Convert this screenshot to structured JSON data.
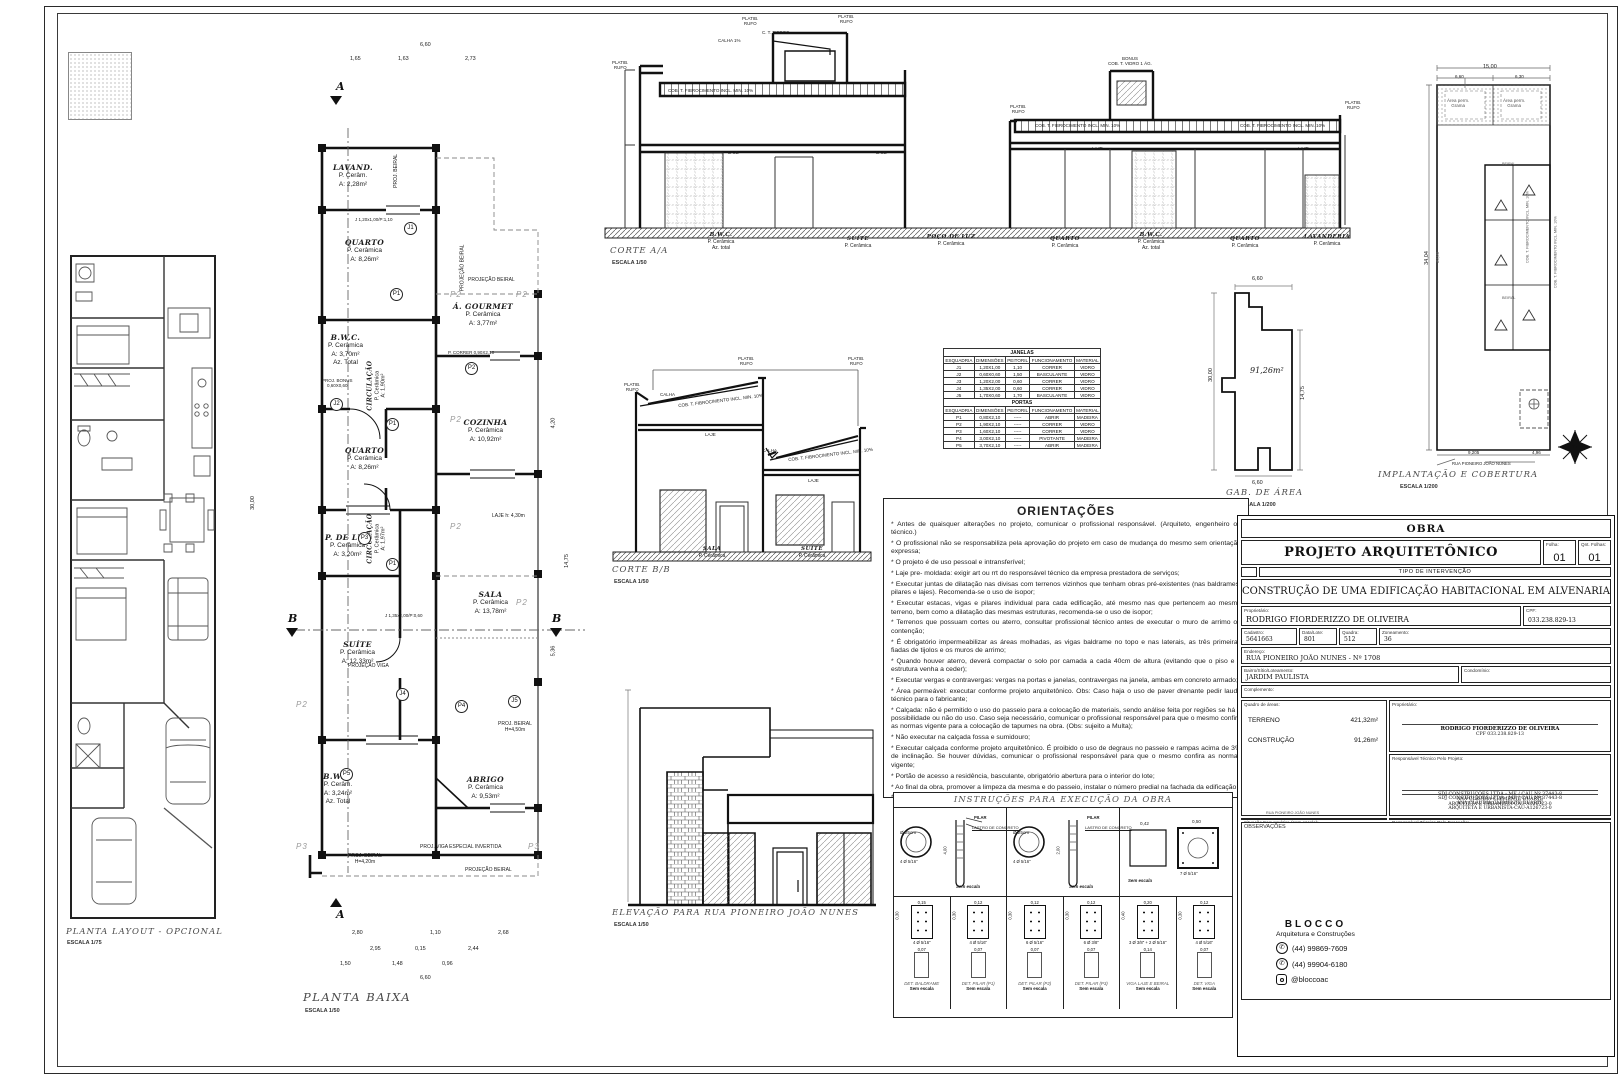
{
  "markers": {
    "a": "A",
    "b": "B"
  },
  "planta_layout": {
    "title": "PLANTA LAYOUT - OPCIONAL",
    "scale": "ESCALA 1/75"
  },
  "planta_baixa": {
    "title": "PLANTA BAIXA",
    "scale": "ESCALA 1/50",
    "rooms": [
      {
        "name": "LAVAND.",
        "floor": "P. Cerâm.",
        "area": "A: 2,28m²"
      },
      {
        "name": "QUARTO",
        "floor": "P. Cerâmica",
        "area": "A: 8,26m²"
      },
      {
        "name": "Á. GOURMET",
        "floor": "P. Cerâmica",
        "area": "A: 3,77m²"
      },
      {
        "name": "B.W.C.",
        "floor": "P. Cerâmica",
        "area": "A: 3,70m²",
        "extra": "Az. Total"
      },
      {
        "name": "CIRCULAÇÃO",
        "floor": "P. Cerâmica",
        "area": "A: 1,90m²"
      },
      {
        "name": "QUARTO",
        "floor": "P. Cerâmica",
        "area": "A: 8,26m²"
      },
      {
        "name": "COZINHA",
        "floor": "P. Cerâmica",
        "area": "A: 10,92m²"
      },
      {
        "name": "P. DE LUZ",
        "floor": "P. Cerâmica",
        "area": "A: 3,20m²"
      },
      {
        "name": "CIRCULAÇÃO",
        "floor": "P. Cerâmica",
        "area": "A: 1,97m²"
      },
      {
        "name": "SALA",
        "floor": "P. Cerâmica",
        "area": "A: 13,78m²"
      },
      {
        "name": "SUÍTE",
        "floor": "P. Cerâmica",
        "area": "A: 12,33m²"
      },
      {
        "name": "B.W.C.",
        "floor": "P. Cerâm.",
        "area": "A: 3,24m²",
        "extra": "Az. Total"
      },
      {
        "name": "ABRIGO",
        "floor": "P. Cerâmica",
        "area": "A: 9,53m²"
      }
    ],
    "ann": {
      "proj_beiral": "PROJ. BEIRAL",
      "projecao_beiral": "PROJEÇÃO BEIRAL",
      "laje": "LAJE  h: 4,30m",
      "projecao_viga": "PROJEÇÃO VIGA",
      "proj_viga_esp": "PROJ. VIGA ESPECIAL INVERTIDA",
      "beiral450a": "PROJ. BEIRAL",
      "beiral450b": "H=4,50m",
      "beiral420a": "PROJ. BEIRAL",
      "beiral420b": "H=4,20m",
      "bonus1": "PROJ. BONUS",
      "bonus2": "0,60X0,60",
      "j1": "J 1,20x1,00/P:1,10",
      "p2t": "P. CORRER 0,90X2,10",
      "j4": "J 1,35x2,00/P:0,60",
      "tagJ1": "J1",
      "tagJ2": "J2",
      "tagJ4": "J4",
      "tagJ5": "J5",
      "tagP1": "P1",
      "tagP2": "P2",
      "tagP3": "P3",
      "tagP4": "P4",
      "tagP5": "P5",
      "p2g": "P2",
      "p3g": "P3"
    },
    "dims": {
      "top": "6,60",
      "t1": "1,65",
      "t2": "1,63",
      "t3": "2,73",
      "left": "30,00",
      "r1": "4,20",
      "r2": "14,75",
      "r3": "5,36",
      "b1a": "2,80",
      "b1b": "1,10",
      "b1c": "2,68",
      "b2a": "2,95",
      "b2b": "0,15",
      "b2c": "2,44",
      "b3a": "1,50",
      "b3b": "1,48",
      "b3c": "0,96",
      "b4": "6,60"
    }
  },
  "corte_a": {
    "title": "CORTE A/A",
    "scale": "ESCALA 1/50",
    "rooms": [
      {
        "name": "B.W.C.",
        "floor": "P. Cerâmica",
        "extra": "Az. total"
      },
      {
        "name": "SUÍTE",
        "floor": "P. Cerâmica"
      },
      {
        "name": "POÇO DE LUZ",
        "floor": "P. Cerâmica"
      },
      {
        "name": "QUARTO",
        "floor": "P. Cerâmica"
      },
      {
        "name": "B.W.C.",
        "floor": "P. Cerâmica",
        "extra": "Az. total"
      },
      {
        "name": "QUARTO",
        "floor": "P. Cerâmica"
      },
      {
        "name": "LAVANDERIA",
        "floor": "P. Cerâmica"
      }
    ],
    "ann": {
      "platib": "PLATIB.",
      "rufo": "RUFO",
      "caixa": "C. T. FIBROC.",
      "calha": "CALHA 1%",
      "cob": "COB. T. FIBROCIMENTO INCL. MIN. 10%",
      "bonus": "BONUS",
      "vidro": "COB. T. VIDRO 1 ÁG.",
      "laje": "LAJE"
    }
  },
  "corte_b": {
    "title": "CORTE B/B",
    "scale": "ESCALA 1/50",
    "rooms": [
      {
        "name": "SALA",
        "floor": "P. Cerâmica"
      },
      {
        "name": "SUÍTE",
        "floor": "P. Cerâmica"
      }
    ],
    "ann": {
      "platib": "PLATIB.",
      "rufo": "RUFO",
      "calha": "CALHA",
      "cob": "COB. T. FIBROCIMENTO INCL. MIN. 10%",
      "laje": "LAJE"
    }
  },
  "schedule": {
    "janelas_title": "JANELAS",
    "portas_title": "PORTAS",
    "headers": [
      "ESQUADRIA",
      "DIMENSÕES",
      "PEITORIL",
      "FUNCIONAMENTO",
      "MATERIAL"
    ],
    "janelas": [
      [
        "J1",
        "1,20X1,00",
        "1,10",
        "CORRER",
        "VIDRO"
      ],
      [
        "J2",
        "0,60X0,60",
        "1,50",
        "BASCULANTE",
        "VIDRO"
      ],
      [
        "J3",
        "1,20X2,00",
        "0,60",
        "CORRER",
        "VIDRO"
      ],
      [
        "J4",
        "1,35X2,00",
        "0,60",
        "CORRER",
        "VIDRO"
      ],
      [
        "J5",
        "1,70X0,60",
        "1,70",
        "BASCULANTE",
        "VIDRO"
      ]
    ],
    "portas": [
      [
        "P1",
        "0,80X2,10",
        "-----",
        "ABRIR",
        "MADEIRA"
      ],
      [
        "P2",
        "1,90X2,10",
        "-----",
        "CORRER",
        "VIDRO"
      ],
      [
        "P3",
        "1,60X2,10",
        "-----",
        "CORRER",
        "VIDRO"
      ],
      [
        "P4",
        "3,00X2,10",
        "-----",
        "PIVOTANTE",
        "MADEIRA"
      ],
      [
        "P5",
        "3,70X2,10",
        "-----",
        "ABRIR",
        "MADEIRA"
      ]
    ]
  },
  "gab": {
    "title": "GAB. DE ÁREA",
    "scale": "ESCALA 1/200",
    "area": "91,26m²",
    "dim_top": "6,60",
    "dim_left": "30,00",
    "dim_right": "14,75",
    "dim_bottom": "6,60"
  },
  "implantacao": {
    "title": "IMPLANTAÇÃO E COBERTURA",
    "scale": "ESCALA 1/200",
    "street": "RUA PIONEIRO JOÃO NUNES",
    "perm1": "Área perm.",
    "perm2": "Grama",
    "dim_top": "15,00",
    "dim_t1": "6,60",
    "dim_t2": "6,30",
    "dim_left": "34,04",
    "dim_left2": "30,00",
    "dim_b1": "9,205",
    "dim_b2": "4,96",
    "beiral": "BEIRAL",
    "cob": "COB. T. FIBROCIMENTO INCL. MIN. 10%"
  },
  "orientacoes": {
    "title": "ORIENTAÇÕES",
    "items": [
      "* Antes de quaisquer alterações no projeto, comunicar o profissional responsável. (Arquiteto, engenheiro ou técnico.)",
      "* O profissional não se responsabiliza pela aprovação do projeto em caso de mudança do mesmo sem orientação expressa;",
      "* O projeto é de uso pessoal e intransferível;",
      "* Laje pre- moldada: exigir art ou rrt do responsável técnico da empresa prestadora de serviços;",
      "* Executar juntas de dilatação nas divisas com terrenos vizinhos que tenham obras pré-existentes (nas baldrames, pilares e lajes). Recomenda-se o uso de isopor;",
      "* Executar estacas, vigas e pilares individual para cada edificação, até mesmo nas que pertencem ao mesmo terreno, bem como a dilatação das mesmas estruturas, recomenda-se o uso de isopor;",
      "* Terrenos que possuam cortes ou aterro, consultar profissional técnico antes de executar o muro de arrimo ou contenção;",
      "* É obrigatório impermeabilizar as áreas molhadas, as vigas baldrame no topo e nas laterais, as três primeiras fiadas de tijolos e os muros de arrimo;",
      "* Quando houver aterro, deverá compactar o solo por camada a cada 40cm de altura (evitando que o piso e a estrutura venha a ceder);",
      "* Executar vergas e contravergas: vergas na portas e janelas, contravergas na janela, ambas em concreto armado;",
      "* Área permeável: executar conforme projeto arquitetônico. Obs: Caso haja o uso de paver drenante pedir laudo técnico para o fabricante;",
      "* Calçada: não é permitido o uso do passeio para a colocação de materiais, sendo análise feita por regiões se há a possibilidade ou não do uso. Caso seja necessário, comunicar o profissional responsável para que o mesmo confira as normas vigente para a colocação de tapumes na obra. (Obs: sujeito a Multa);",
      "* Não executar na calçada fossa e sumidouro;",
      "* Executar calçada conforme projeto arquitetônico. É proibido o uso de degraus no passeio e rampas acima de 3% de inclinação. Se houver dúvidas, comunicar o profissional responsável para que o mesmo confira as normas vigente;",
      "* Portão de acesso a residência, basculante, obrigatório abertura para o interior do lote;",
      "* Ao final da obra, promover a limpeza da mesma e do passeio, instalar o número predial na fachada da edificação;",
      "* Após a conclusão da obra deverá ser pedido o certificado de conclusão de edificação (Habite-se)."
    ]
  },
  "elevacao": {
    "title": "ELEVAÇÃO PARA RUA PIONEIRO JOÃO NUNES",
    "scale": "ESCALA 1/50"
  },
  "instrucoes": {
    "title": "INSTRUÇÕES PARA EXECUÇÃO DA OBRA",
    "sem_escala": "Sem escala",
    "estaca": {
      "d": "Ø 25cm",
      "aco": "4 Ø 5/16\"",
      "pilar": "PILAR",
      "lastro": "LASTRO DE CONCRETO",
      "h1": "4,00",
      "h2": "2,00",
      "h3": "0,60"
    },
    "bloco": {
      "d1": "0,42",
      "d2": "0,50",
      "aco": "7 Ø 5/16\""
    },
    "cells": [
      {
        "w": "0,15",
        "h": "0,30",
        "aco": "4 Ø 5/16\"",
        "name": "DET. BALDRAME",
        "w2": "0,07"
      },
      {
        "w": "0,12",
        "h": "0,30",
        "aco": "4 Ø 5/16\"",
        "name": "DET. PILAR (P1)",
        "w2": "0,07"
      },
      {
        "w": "0,12",
        "h": "0,30",
        "aco": "6 Ø 5/16\"",
        "name": "DET. PILAR (P2)",
        "w2": "0,07"
      },
      {
        "w": "0,12",
        "h": "0,30",
        "aco": "6 Ø 3/8\"",
        "name": "DET. PILAR (P3)",
        "w2": "0,07"
      },
      {
        "w": "0,20",
        "h": "0,40",
        "aco": "3 Ø 3/8\" + 2 Ø 5/16\"",
        "name": "VIGA LAJE E BEIRAL",
        "w2": "0,14"
      },
      {
        "w": "0,12",
        "h": "0,30",
        "aco": "4 Ø 5/16\"",
        "name": "DET. VIGA",
        "w2": "0,07"
      }
    ]
  },
  "title_block": {
    "obra": "OBRA",
    "projeto": "PROJETO ARQUITETÔNICO",
    "folha_label": "Folha:",
    "folha": "01",
    "qnt_label": "Qnt. Folhas:",
    "qnt": "01",
    "tipo": "TIPO DE INTERVENÇÃO",
    "descricao": "CONSTRUÇÃO DE UMA EDIFICAÇÃO HABITACIONAL EM ALVENARIA",
    "proprietario_label": "Proprietário:",
    "proprietario": "RODRIGO FIORDERIZZO DE OLIVEIRA",
    "cpf_label": "CPF:",
    "cpf": "033.238.829-13",
    "cadastro_label": "Cadastro:",
    "cadastro": "5641663",
    "lote_label": "Data/Lote:",
    "lote": "801",
    "quadra_label": "Quadra:",
    "quadra": "512",
    "zoneamento_label": "Zoneamento:",
    "zoneamento": "36",
    "endereco_label": "Endereço:",
    "endereco": "RUA PIONEIRO JOÃO NUNES - Nº 1708",
    "bairro_label": "Bairro/Sítio/Loteamento:",
    "bairro": "JARDIM PAULISTA",
    "condominio_label": "Condomínio:",
    "complemento_label": "Complemento:",
    "quadro_label": "Quadro de áreas:",
    "terreno_label": "TERRENO",
    "terreno": "421,32m²",
    "construcao_label": "CONSTRUÇÃO",
    "construcao": "91,26m²",
    "prop_box_label": "Proprietário:",
    "sig_nome": "RODRIGO FIORDERIZZO DE OLIVEIRA",
    "sig_cpf": "CPF 033.238.829-13",
    "rt_projeto_label": "Responsável Técnico Pelo Projeto:",
    "rt_execucao_label": "Responsável Técnico Pela Execução:",
    "empresa1": "SDJ CONSTRUÇÕES LTDA - ME / CAU Nº 37443-8",
    "empresa2": "ANA CLÁUDIA CLEMENTE DUARTE",
    "empresa3": "ARQUITETA E URBANISTA-CAU-A126723-0",
    "situacao_label": "Situação Esquemática (sem escala):",
    "situacao_street": "RUA PIONEIRO JOÃO NUNES",
    "obs_label": "OBSERVAÇÕES",
    "logo": "BLOCCO",
    "logo_sub": "Arquitetura e Construções",
    "tel1": "(44) 99869-7609",
    "tel2": "(44) 99904-6180",
    "insta": "@bloccoac"
  }
}
